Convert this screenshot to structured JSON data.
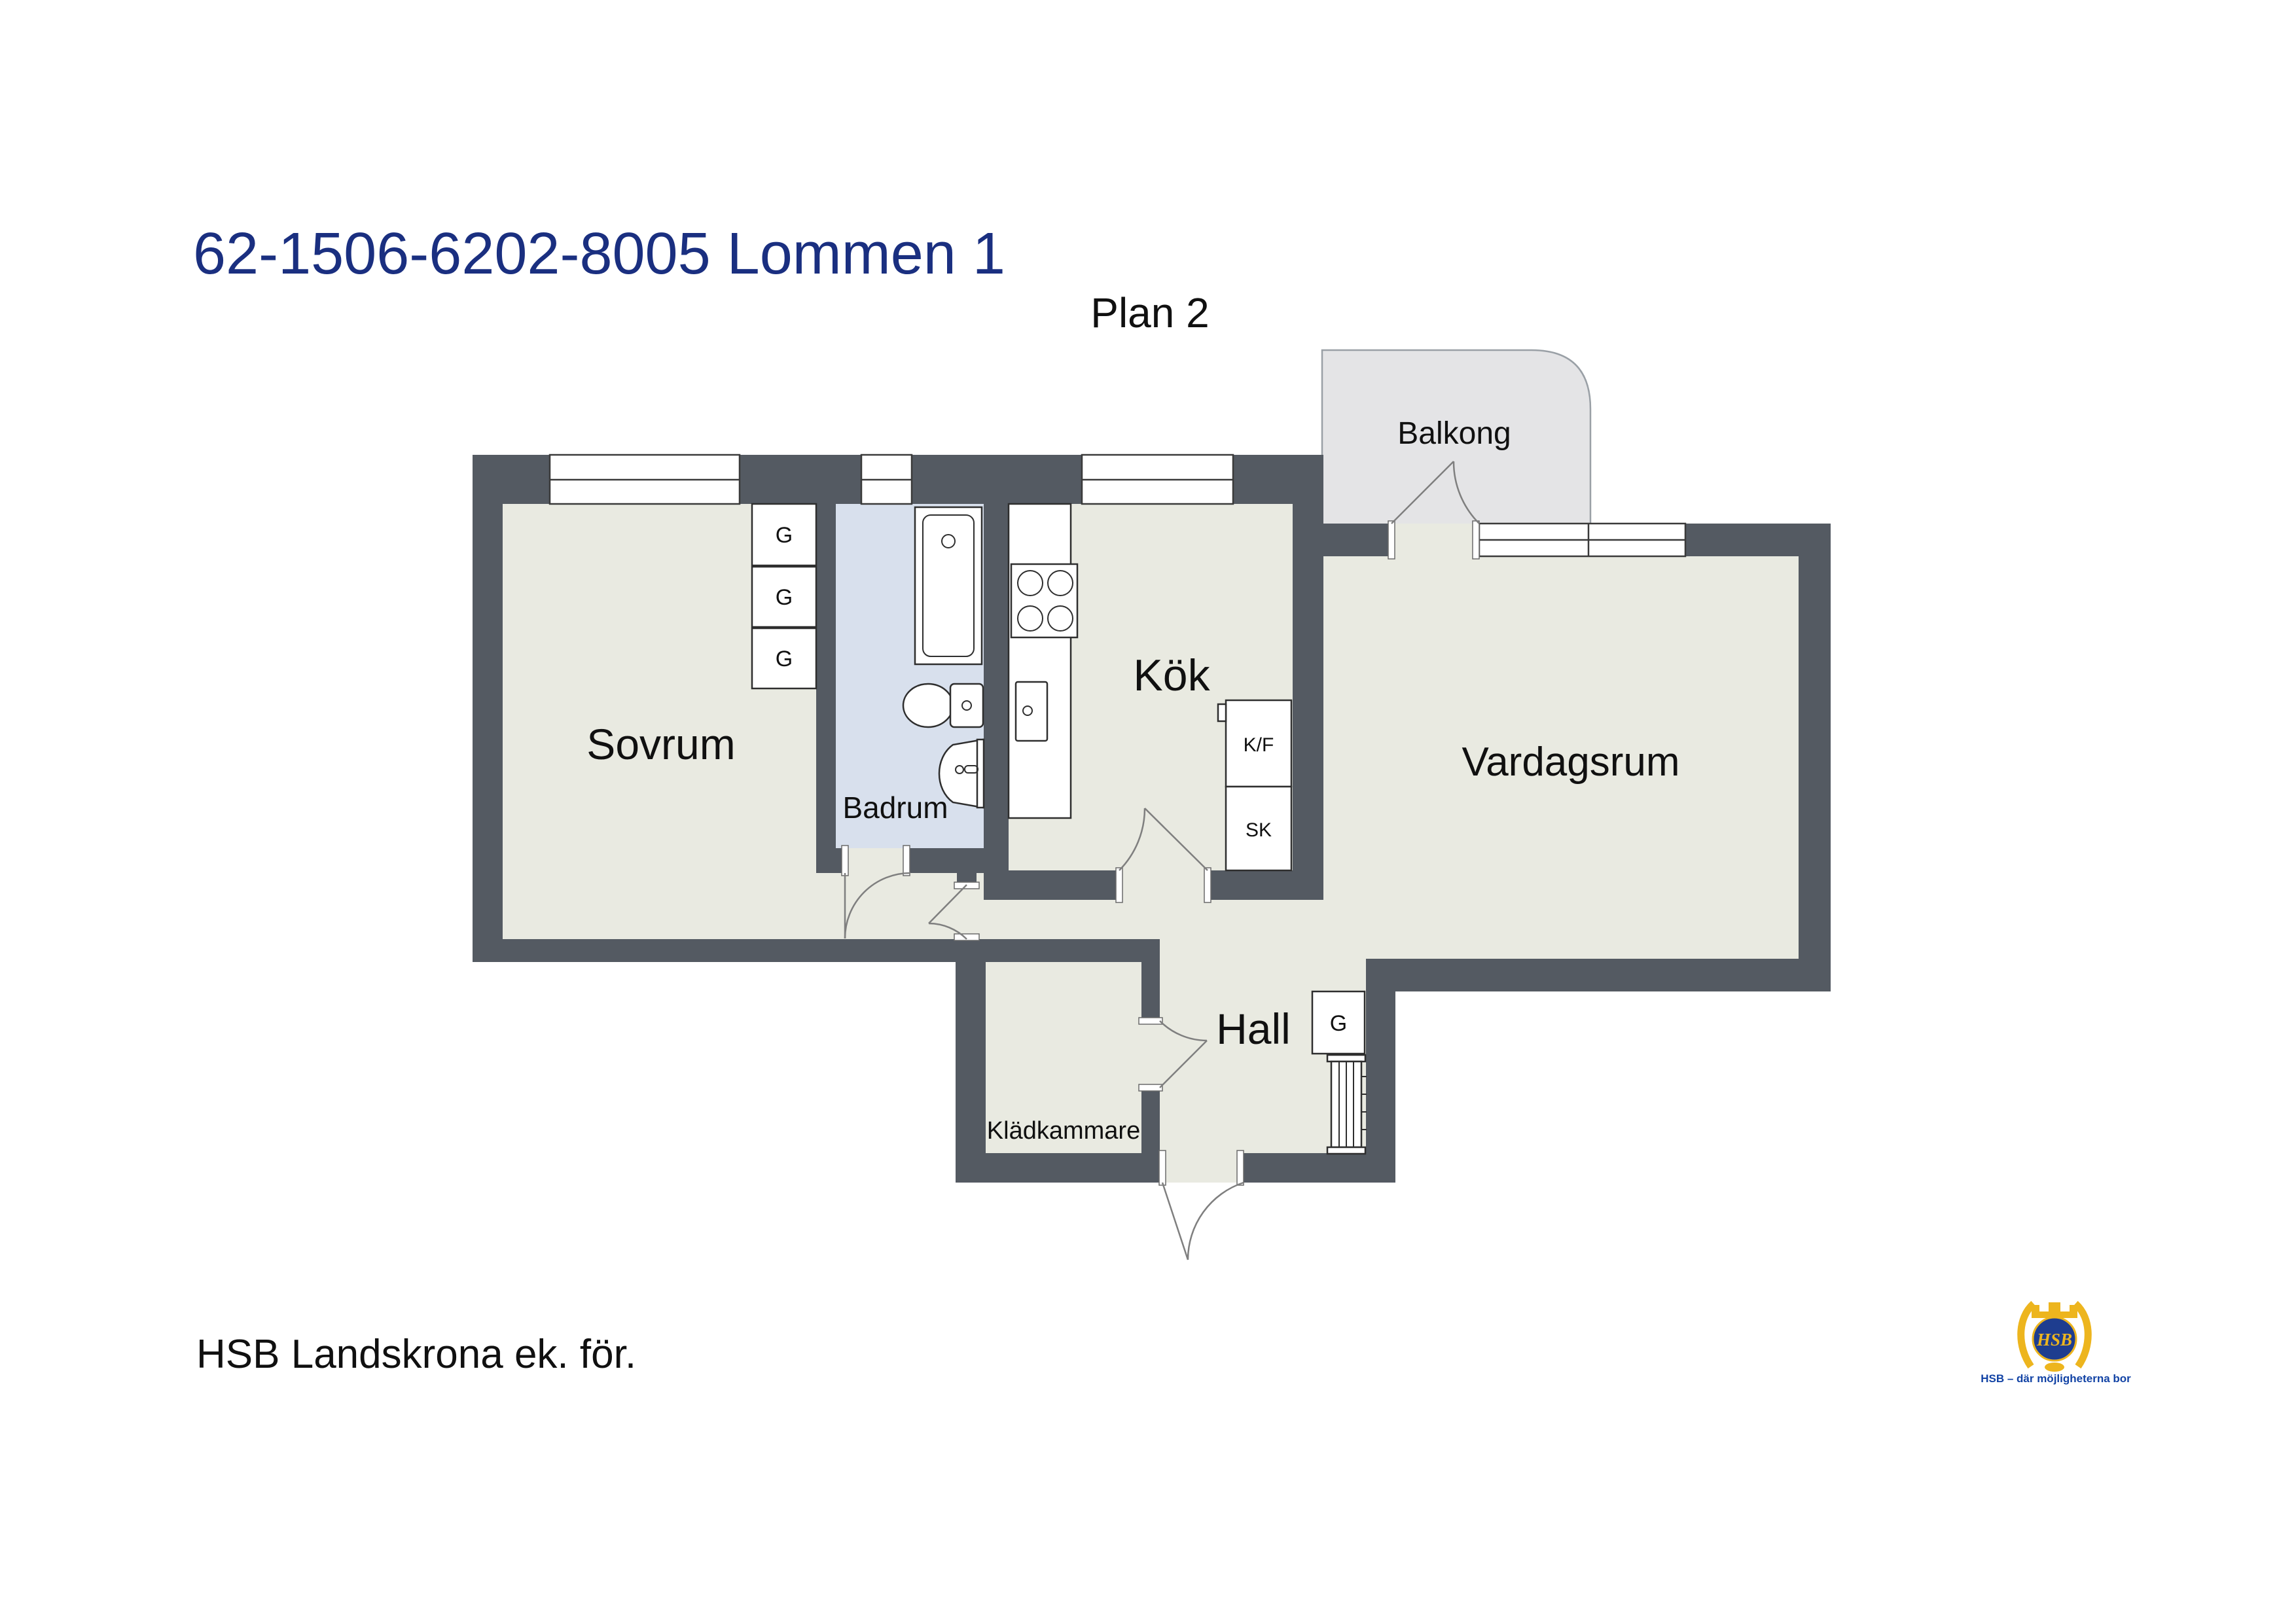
{
  "title": {
    "text": "62-1506-6202-8005 Lommen 1"
  },
  "plan_label": "Plan 2",
  "rooms": {
    "sovrum": "Sovrum",
    "badrum": "Badrum",
    "kok": "Kök",
    "vardagsrum": "Vardagsrum",
    "hall": "Hall",
    "kladkammare": "Klädkammare",
    "balkong": "Balkong"
  },
  "fixtures": {
    "wardrobe": "G",
    "fridge_freezer": "K/F",
    "cabinet": "SK"
  },
  "footer": "HSB Landskrona ek. för.",
  "logo": {
    "monogram": "HSB",
    "caption": "HSB – där möjligheterna bor"
  },
  "colors": {
    "wall": "#545A62",
    "floor": "#E9EAE1",
    "bathroom_floor": "#D8E0ED",
    "balcony_floor": "#E4E4E6",
    "title_blue": "#1A2F80",
    "logo_gold": "#EDB51E",
    "logo_navy": "#1E3D8F",
    "caption_blue": "#1243A5"
  }
}
